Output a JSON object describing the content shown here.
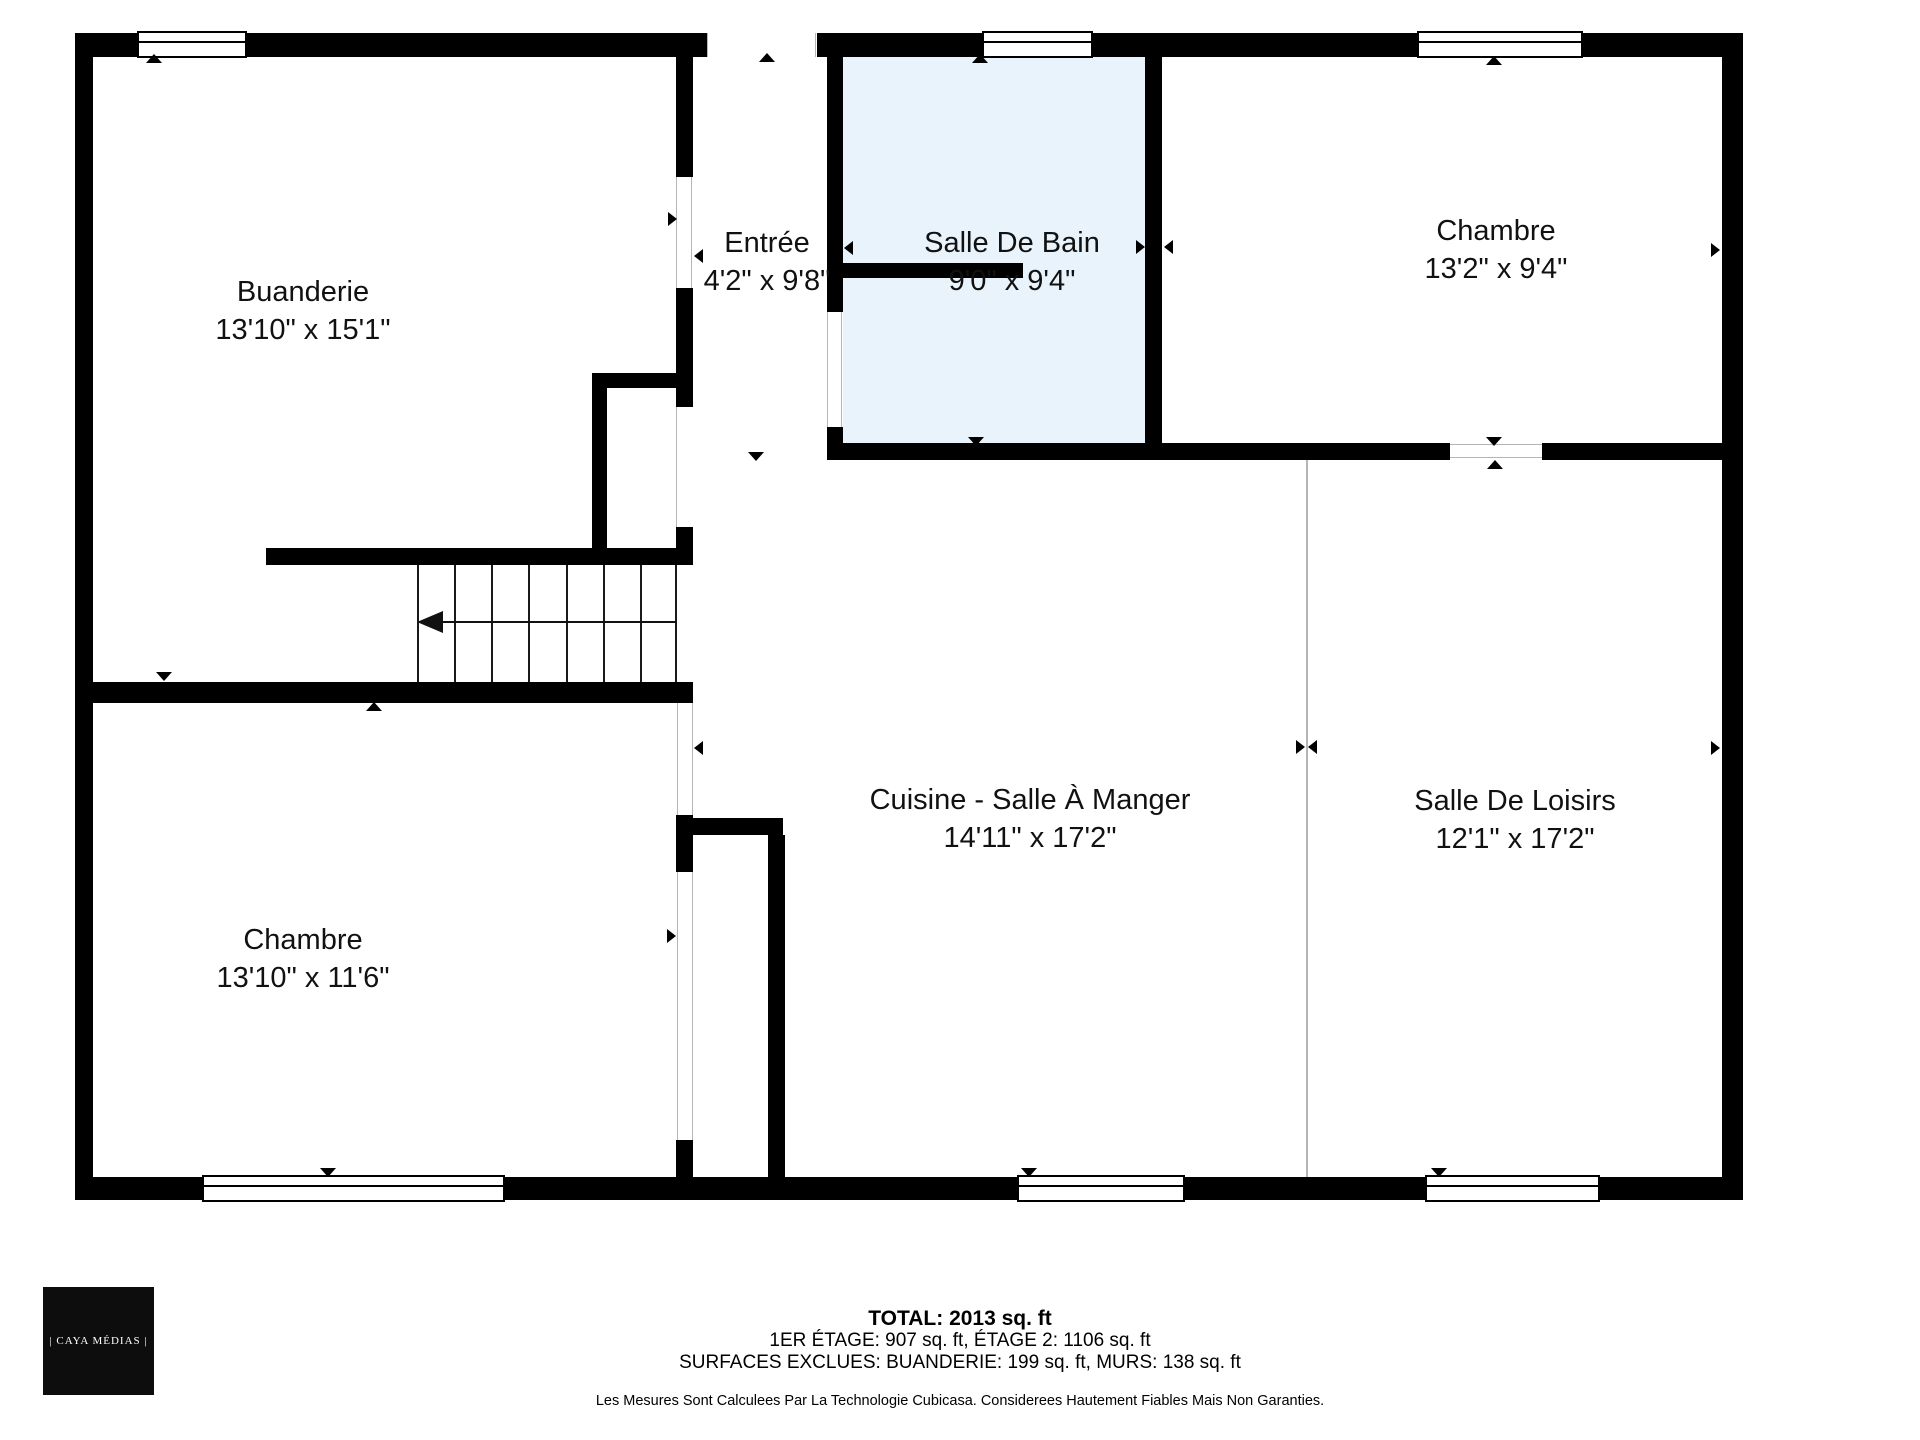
{
  "floorplan": {
    "colors": {
      "wall": "#000000",
      "bathroom_fill": "#e8f3fb",
      "open_boundary_line": "#b5b5b5"
    },
    "rooms": {
      "buanderie": {
        "name": "Buanderie",
        "dimensions": "13'10\" x 15'1\""
      },
      "entree": {
        "name": "Entrée",
        "dimensions": "4'2\" x 9'8\""
      },
      "salle_de_bain": {
        "name": "Salle De Bain",
        "dimensions": "9'0\" x 9'4\""
      },
      "chambre_haut": {
        "name": "Chambre",
        "dimensions": "13'2\" x 9'4\""
      },
      "chambre_bas": {
        "name": "Chambre",
        "dimensions": "13'10\" x 11'6\""
      },
      "cuisine": {
        "name": "Cuisine - Salle À Manger",
        "dimensions": "14'11\" x 17'2\""
      },
      "loisirs": {
        "name": "Salle De Loisirs",
        "dimensions": "12'1\" x 17'2\""
      }
    }
  },
  "footer": {
    "total": "TOTAL: 2013 sq. ft",
    "etages": "1ER ÉTAGE: 907 sq. ft, ÉTAGE 2: 1106 sq. ft",
    "exclusions": "SURFACES EXCLUES: BUANDERIE: 199 sq. ft, MURS: 138 sq. ft",
    "disclaimer": "Les Mesures Sont Calculees Par La Technologie Cubicasa. Considerees Hautement Fiables Mais Non Garanties."
  },
  "logo": {
    "text": "| CAYA MÉDIAS |"
  }
}
